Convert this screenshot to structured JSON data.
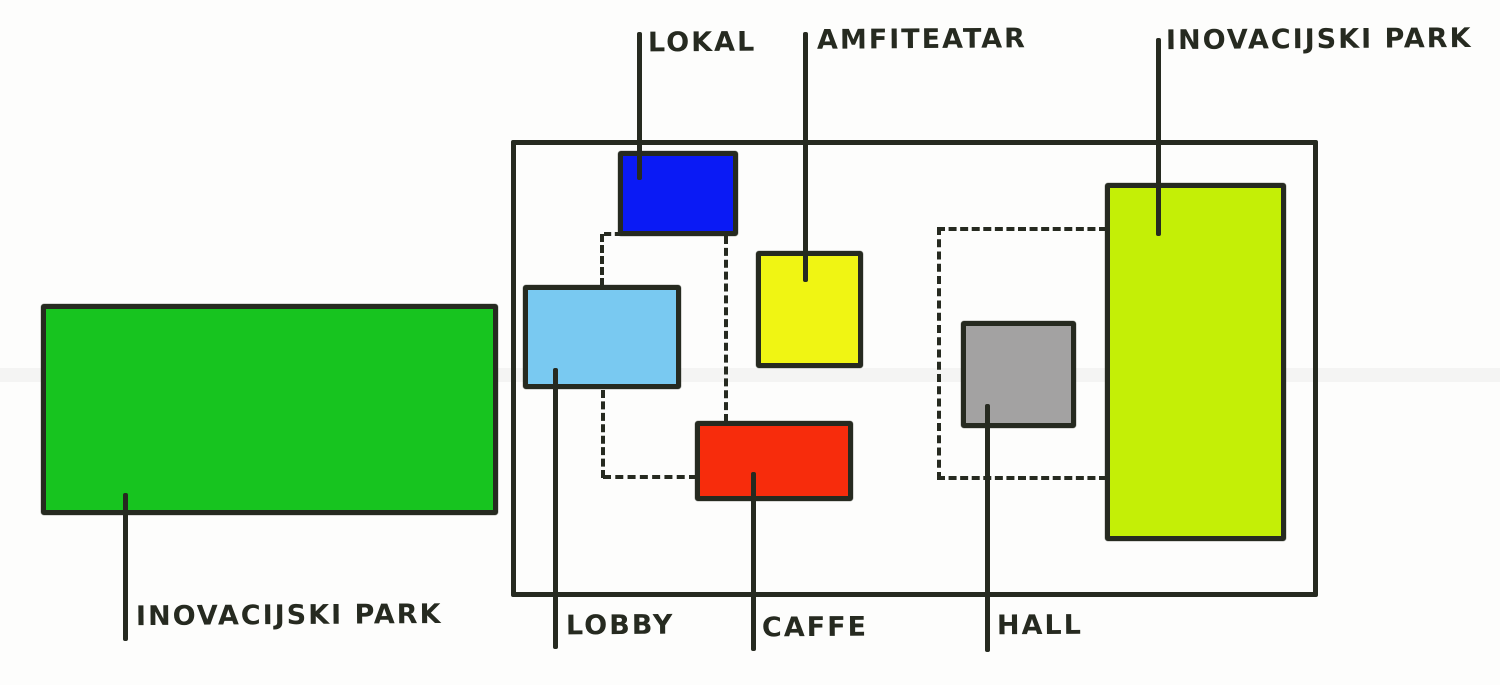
{
  "diagram": {
    "type": "hand-drawn-floor-plan-sketch",
    "ink_color": "#262a20",
    "background_color": "#fdfdfc",
    "rooms": [
      {
        "id": "lokal",
        "label": "LOKAL",
        "color": "#0a1af5"
      },
      {
        "id": "amfiteatar",
        "label": "AMFITEATAR",
        "color": "#f0f513"
      },
      {
        "id": "lobby",
        "label": "LOBBY",
        "color": "#79c9f1"
      },
      {
        "id": "caffe",
        "label": "CAFFE",
        "color": "#f72c0c"
      },
      {
        "id": "hall",
        "label": "HALL",
        "color": "#a3a2a2"
      },
      {
        "id": "inovacijski-park-right",
        "label": "INOVACIJSKI PARK",
        "color": "#c4ef06"
      },
      {
        "id": "inovacijski-park-left",
        "label": "INOVACIJSKI PARK",
        "color": "#17c41f"
      }
    ]
  }
}
